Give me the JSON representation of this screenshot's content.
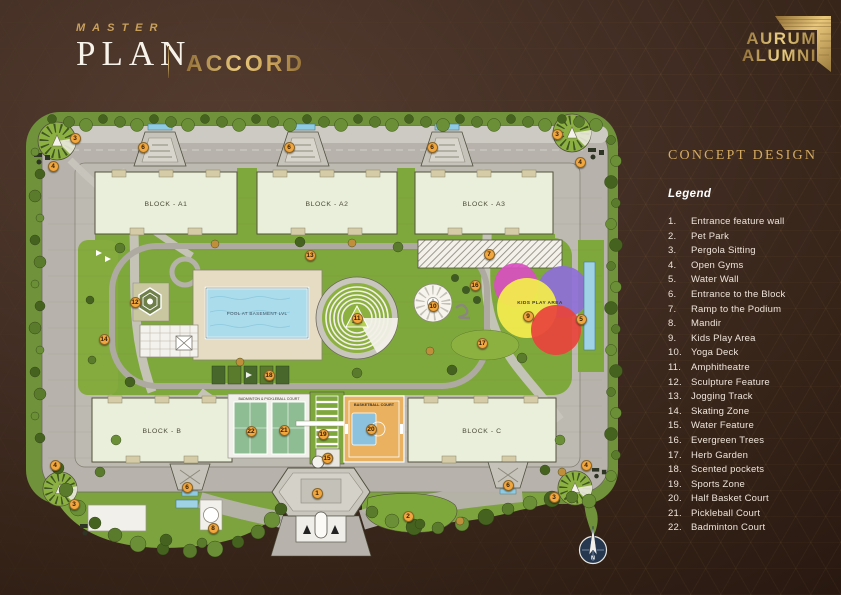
{
  "header": {
    "master_label": "MASTER",
    "plan_label": "PLAN",
    "project_name": "ACCORD"
  },
  "logo": {
    "line1": "AURUM",
    "line2": "ALUMNI"
  },
  "panel": {
    "title": "CONCEPT DESIGN",
    "legend_label": "Legend",
    "items": [
      {
        "num": "1.",
        "label": "Entrance feature wall"
      },
      {
        "num": "2.",
        "label": "Pet Park"
      },
      {
        "num": "3.",
        "label": "Pergola Sitting"
      },
      {
        "num": "4.",
        "label": "Open Gyms"
      },
      {
        "num": "5.",
        "label": "Water Wall"
      },
      {
        "num": "6.",
        "label": "Entrance to the Block"
      },
      {
        "num": "7.",
        "label": "Ramp to the Podium"
      },
      {
        "num": "8.",
        "label": "Mandir"
      },
      {
        "num": "9.",
        "label": "Kids Play Area"
      },
      {
        "num": "10.",
        "label": "Yoga Deck"
      },
      {
        "num": "11.",
        "label": "Amphitheatre"
      },
      {
        "num": "12.",
        "label": "Sculpture Feature"
      },
      {
        "num": "13.",
        "label": "Jogging Track"
      },
      {
        "num": "14.",
        "label": "Skating Zone"
      },
      {
        "num": "15.",
        "label": "Water Feature"
      },
      {
        "num": "16.",
        "label": "Evergreen Trees"
      },
      {
        "num": "17.",
        "label": "Herb Garden"
      },
      {
        "num": "18.",
        "label": "Scented pockets"
      },
      {
        "num": "19.",
        "label": "Sports Zone"
      },
      {
        "num": "20.",
        "label": "Half Basket Court"
      },
      {
        "num": "21.",
        "label": "Pickleball Court"
      },
      {
        "num": "22.",
        "label": "Badminton Court"
      }
    ]
  },
  "plan": {
    "blocks": [
      "BLOCK - A1",
      "BLOCK - A2",
      "BLOCK - A3",
      "BLOCK - B",
      "BLOCK - C"
    ],
    "labels": {
      "pool": "POOL AT BASEMENT LVL",
      "kids": "KIDS PLAY AREA",
      "basketball": "BASKETBALL COURT",
      "badminton": "BADMINTON & PICKLEBALL COURT",
      "north": "N"
    },
    "markers": [
      {
        "n": "3",
        "x": 75,
        "y": 138
      },
      {
        "n": "4",
        "x": 53,
        "y": 166
      },
      {
        "n": "6",
        "x": 143,
        "y": 147
      },
      {
        "n": "6",
        "x": 289,
        "y": 147
      },
      {
        "n": "6",
        "x": 432,
        "y": 147
      },
      {
        "n": "3",
        "x": 557,
        "y": 134
      },
      {
        "n": "4",
        "x": 580,
        "y": 162
      },
      {
        "n": "13",
        "x": 310,
        "y": 255
      },
      {
        "n": "7",
        "x": 489,
        "y": 254
      },
      {
        "n": "16",
        "x": 475,
        "y": 285
      },
      {
        "n": "12",
        "x": 135,
        "y": 302
      },
      {
        "n": "10",
        "x": 433,
        "y": 306
      },
      {
        "n": "11",
        "x": 357,
        "y": 318
      },
      {
        "n": "9",
        "x": 528,
        "y": 316
      },
      {
        "n": "5",
        "x": 581,
        "y": 319
      },
      {
        "n": "14",
        "x": 104,
        "y": 339
      },
      {
        "n": "17",
        "x": 482,
        "y": 343
      },
      {
        "n": "18",
        "x": 269,
        "y": 375
      },
      {
        "n": "22",
        "x": 251,
        "y": 431
      },
      {
        "n": "21",
        "x": 284,
        "y": 430
      },
      {
        "n": "20",
        "x": 371,
        "y": 429
      },
      {
        "n": "19",
        "x": 323,
        "y": 434
      },
      {
        "n": "15",
        "x": 327,
        "y": 458
      },
      {
        "n": "4",
        "x": 55,
        "y": 465
      },
      {
        "n": "4",
        "x": 586,
        "y": 465
      },
      {
        "n": "6",
        "x": 187,
        "y": 487
      },
      {
        "n": "6",
        "x": 508,
        "y": 485
      },
      {
        "n": "1",
        "x": 317,
        "y": 493
      },
      {
        "n": "3",
        "x": 74,
        "y": 504
      },
      {
        "n": "3",
        "x": 554,
        "y": 497
      },
      {
        "n": "2",
        "x": 408,
        "y": 516
      },
      {
        "n": "8",
        "x": 213,
        "y": 528
      }
    ]
  },
  "colors": {
    "accent_gold": "#d4ab60",
    "marker": "#f2a63e",
    "background": "#3a281e"
  }
}
